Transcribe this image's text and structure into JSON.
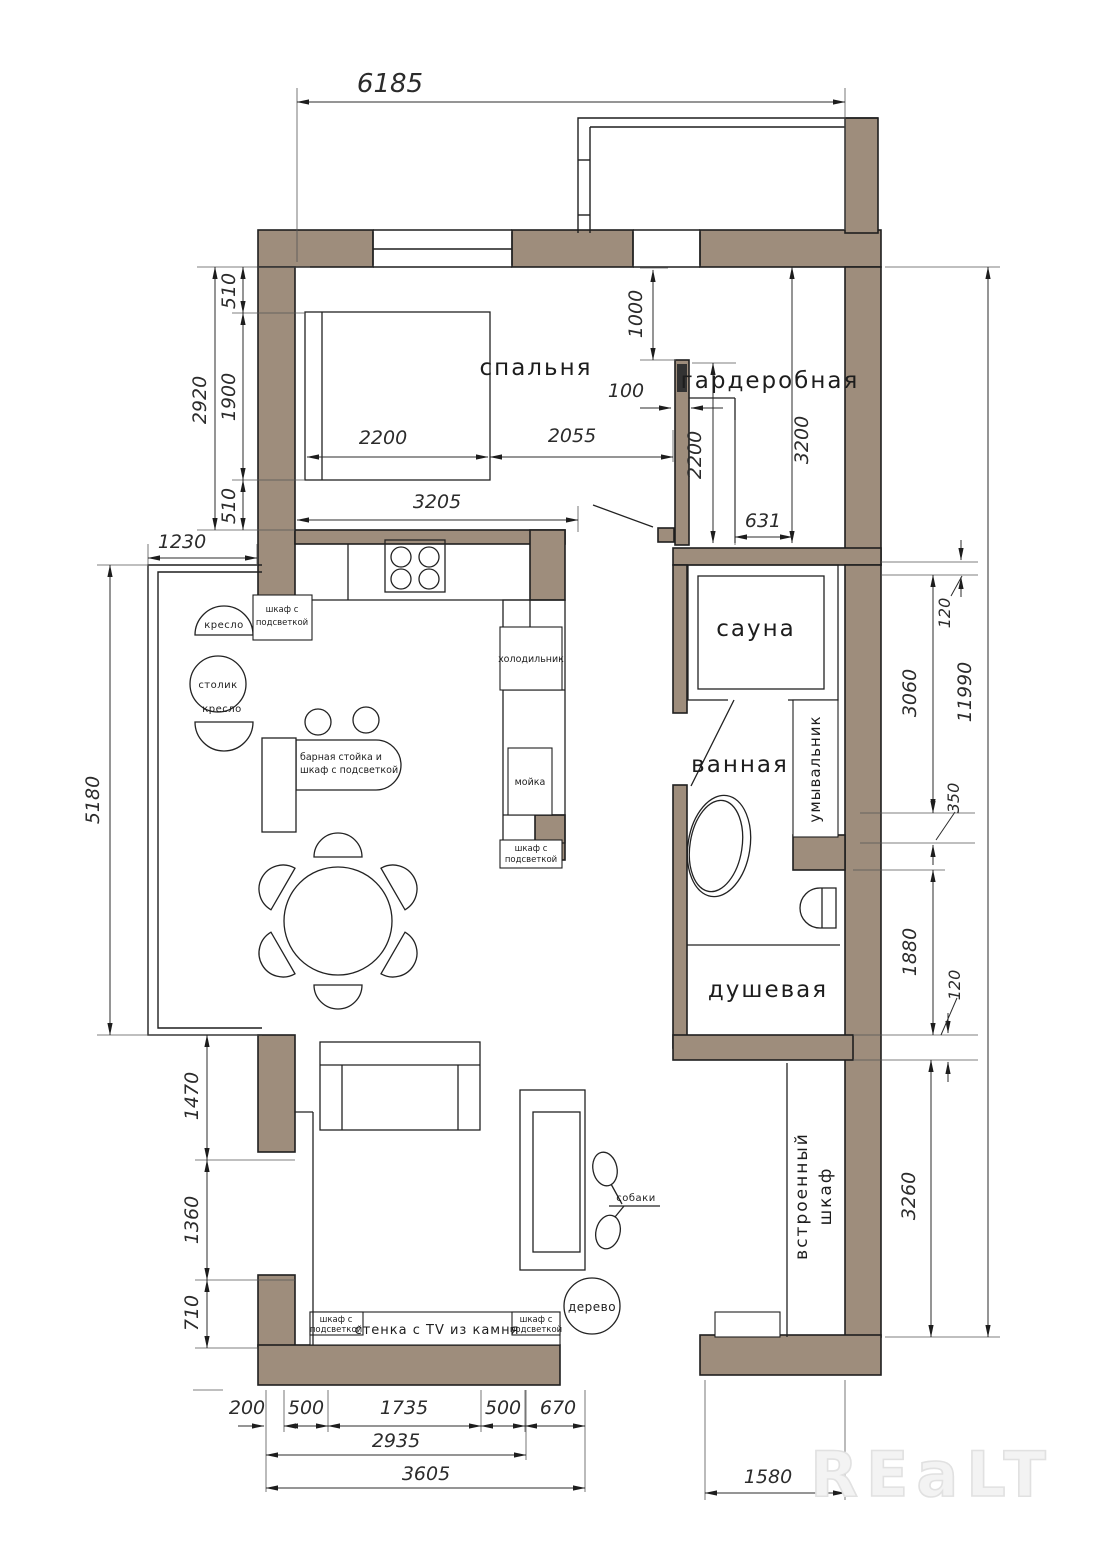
{
  "watermark": "REaLT",
  "colors": {
    "wall": "#9e8d7c",
    "line": "#1f1f1f"
  },
  "rooms": {
    "bedroom": "спальня",
    "wardrobe": "гардеробная",
    "sauna": "сауна",
    "bathroom": "ванная",
    "washbasin": "умывальник",
    "shower": "душевая",
    "builtin_line1": "встроенный",
    "builtin_line2": "шкаф"
  },
  "furniture": {
    "armchair_top": "кресло",
    "armchair_bottom": "кресло",
    "side_table": "столик",
    "cabinet_light_line1": "шкаф с",
    "cabinet_light_line2": "подсветкой",
    "fridge": "холодильник",
    "sink": "мойка",
    "bar_line1": "барная стойка и",
    "bar_line2": "шкаф с подсветкой",
    "tv_wall": "стенка с TV из камня",
    "dogs": "собаки",
    "tree": "дерево"
  },
  "dims": {
    "top_width": "6185",
    "bedroom_height": "2920",
    "bed_offset_top": "510",
    "bed_length": "1900",
    "bed_offset_bottom": "510",
    "bay_offset": "1230",
    "bay_height": "5180",
    "living_seg1": "1470",
    "living_seg2": "1360",
    "living_seg3": "710",
    "bottom_seg1": "200",
    "bottom_seg2": "500",
    "bottom_seg3": "1735",
    "bottom_seg4": "500",
    "bottom_seg5": "670",
    "bottom_sub": "2935",
    "bottom_total": "3605",
    "bottom_right": "1580",
    "bed_width": "2200",
    "bed_to_wall": "2055",
    "bedroom_width": "3205",
    "ward_offset": "1000",
    "ward_gap": "100",
    "ward_inner": "2200",
    "ward_height": "3200",
    "ward_width": "631",
    "wall_thick_a": "120",
    "sauna_zone": "3060",
    "niche_depth": "350",
    "shower_zone": "1880",
    "wall_thick_b": "120",
    "closet_zone": "3260",
    "right_total": "11990"
  }
}
